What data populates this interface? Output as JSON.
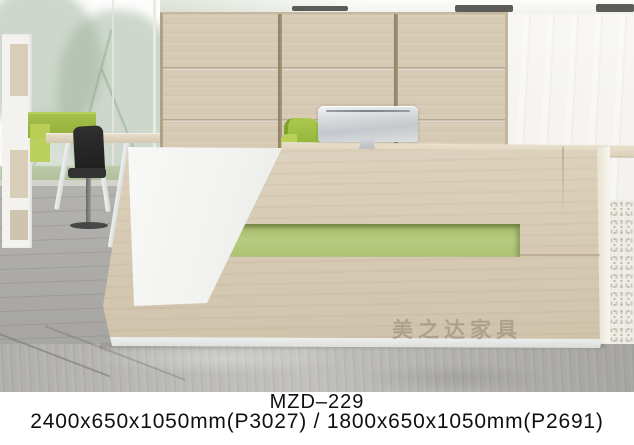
{
  "caption": {
    "model": "MZD–229",
    "dimensions": "2400x650x1050mm(P3027) / 1800x650x1050mm(P2691)"
  },
  "watermark": {
    "text": "美之达家具"
  },
  "icons": {
    "apple_logo": ""
  },
  "colors": {
    "wood_panel": "#d6cab5",
    "wood_divider": "#8d7e64",
    "accent_green_stripe": "#b2c87a",
    "chair_green": "#a3c045",
    "white_panel": "#f4f4f2",
    "concrete_floor": "#b6b5b1",
    "caption_text": "#0f0f0f"
  }
}
